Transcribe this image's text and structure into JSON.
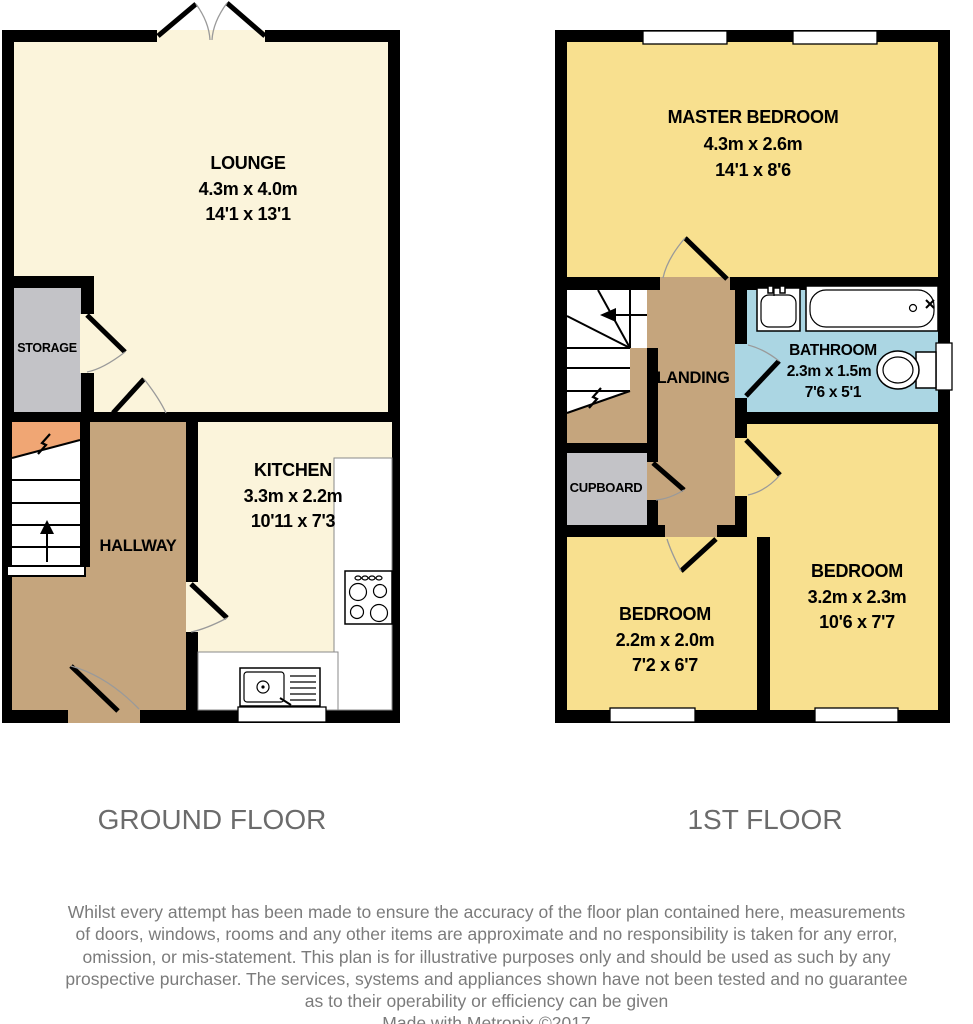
{
  "floors": {
    "ground": {
      "label": "GROUND FLOOR",
      "rooms": {
        "lounge": {
          "name": "LOUNGE",
          "metric": "4.3m x 4.0m",
          "imperial": "14'1 x 13'1"
        },
        "storage": {
          "name": "STORAGE"
        },
        "kitchen": {
          "name": "KITCHEN",
          "metric": "3.3m x 2.2m",
          "imperial": "10'11 x 7'3"
        },
        "hallway": {
          "name": "HALLWAY"
        }
      }
    },
    "first": {
      "label": "1ST FLOOR",
      "rooms": {
        "master_bedroom": {
          "name": "MASTER BEDROOM",
          "metric": "4.3m x 2.6m",
          "imperial": "14'1 x 8'6"
        },
        "landing": {
          "name": "LANDING"
        },
        "bathroom": {
          "name": "BATHROOM",
          "metric": "2.3m x 1.5m",
          "imperial": "7'6 x 5'1"
        },
        "cupboard": {
          "name": "CUPBOARD"
        },
        "bedroom_small": {
          "name": "BEDROOM",
          "metric": "2.2m x 2.0m",
          "imperial": "7'2 x 6'7"
        },
        "bedroom_large": {
          "name": "BEDROOM",
          "metric": "3.2m x 2.3m",
          "imperial": "10'6 x 7'7"
        }
      }
    }
  },
  "footer": {
    "disclaimer_lines": [
      "Whilst every attempt has been made to ensure the accuracy of the floor plan contained here, measurements",
      "of doors, windows, rooms and any other items are approximate and no responsibility is taken for any error,",
      "omission, or mis-statement. This plan is for illustrative purposes only and should be used as such by any",
      "prospective purchaser. The services, systems and appliances shown have not been tested and no guarantee",
      "as to their operability or efficiency can be given"
    ],
    "credit": "Made with Metropix ©2017"
  },
  "colors": {
    "wall": "#000000",
    "lounge_kitchen_floor": "#FBF4DB",
    "bedroom_floor": "#F8E08F",
    "hall_landing_floor": "#C5A57D",
    "storage_cupboard_floor": "#C3C3C7",
    "bathroom_floor": "#ABD6E3",
    "stair_wedge": "#F0A674",
    "door_arc": "#9A9A9A",
    "footer_text": "#7B7B7B"
  }
}
